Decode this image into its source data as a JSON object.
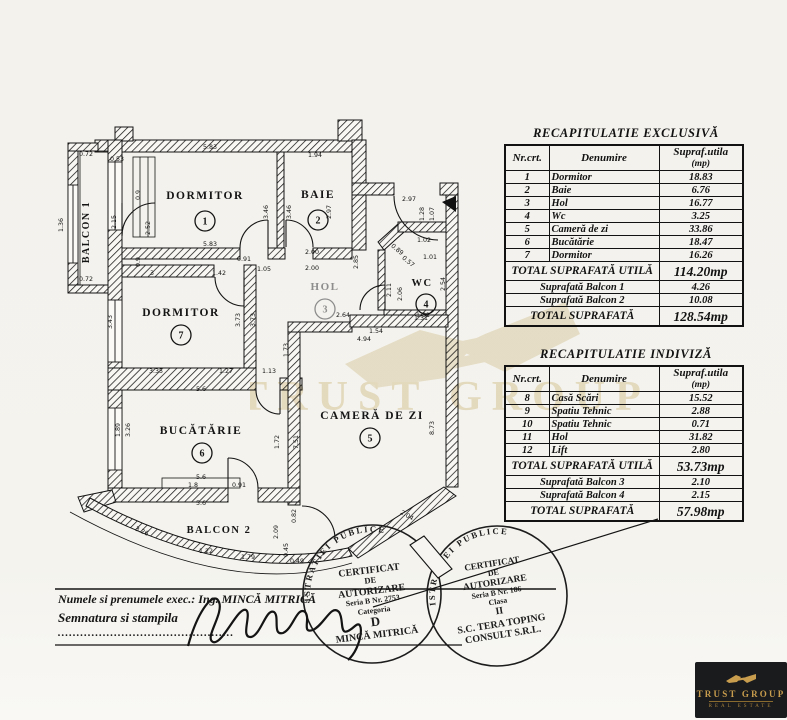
{
  "tables": [
    {
      "title": "RECAPITULATIE  EXCLUSIVĂ",
      "headers": [
        "Nr.crt.",
        "Denumire"
      ],
      "unit_header_line1": "Supraf.utila",
      "unit_header_line2": "(mp)",
      "rows": [
        [
          "1",
          "Dormitor",
          "18.83"
        ],
        [
          "2",
          "Baie",
          "6.76"
        ],
        [
          "3",
          "Hol",
          "16.77"
        ],
        [
          "4",
          "Wc",
          "3.25"
        ],
        [
          "5",
          "Cameră de zi",
          "33.86"
        ],
        [
          "6",
          "Bucătărie",
          "18.47"
        ],
        [
          "7",
          "Dormitor",
          "16.26"
        ]
      ],
      "total_utila_label": "TOTAL SUPRAFATĂ UTILĂ",
      "total_utila_value": "114.20mp",
      "balcon_rows": [
        [
          "Suprafată Balcon 1",
          "4.26"
        ],
        [
          "Suprafată Balcon 2",
          "10.08"
        ]
      ],
      "total_label": "TOTAL SUPRAFATĂ",
      "total_value": "128.54mp"
    },
    {
      "title": "RECAPITULATIE  INDIVIZĂ",
      "headers": [
        "Nr.crt.",
        "Denumire"
      ],
      "unit_header_line1": "Supraf.utila",
      "unit_header_line2": "(mp)",
      "rows": [
        [
          "8",
          "Casă Scări",
          "15.52"
        ],
        [
          "9",
          "Spatiu Tehnic",
          "2.88"
        ],
        [
          "10",
          "Spatiu Tehnic",
          "0.71"
        ],
        [
          "11",
          "Hol",
          "31.82"
        ],
        [
          "12",
          "Lift",
          "2.80"
        ]
      ],
      "total_utila_label": "TOTAL SUPRAFATĂ UTILĂ",
      "total_utila_value": "53.73mp",
      "balcon_rows": [
        [
          "Suprafată Balcon 3",
          "2.10"
        ],
        [
          "Suprafată Balcon 4",
          "2.15"
        ]
      ],
      "total_label": "TOTAL SUPRAFATĂ",
      "total_value": "57.98mp"
    }
  ],
  "floor_plan": {
    "rooms": [
      {
        "name": "balcon-1",
        "label": "BALCON 1",
        "x": 89,
        "y": 232,
        "rot": -90,
        "size": 10
      },
      {
        "name": "dormitor-1",
        "label": "DORMITOR",
        "num": "1",
        "x": 205,
        "y": 199,
        "nx": 205,
        "ny": 221,
        "size": 11.5
      },
      {
        "name": "baie",
        "label": "BAIE",
        "num": "2",
        "x": 318,
        "y": 198,
        "nx": 318,
        "ny": 220,
        "size": 11.5
      },
      {
        "name": "hol",
        "label": "HOL",
        "num": "3",
        "x": 325,
        "y": 290,
        "nx": 325,
        "ny": 309,
        "size": 11,
        "light": true
      },
      {
        "name": "wc",
        "label": "WC",
        "num": "4",
        "x": 422,
        "y": 286,
        "nx": 426,
        "ny": 304,
        "size": 10.5
      },
      {
        "name": "camera-de-zi",
        "label": "CAMERĂ DE ZI",
        "num": "5",
        "x": 372,
        "y": 419,
        "nx": 370,
        "ny": 438,
        "size": 11.5
      },
      {
        "name": "bucatarie",
        "label": "BUCĂTĂRIE",
        "num": "6",
        "x": 201,
        "y": 434,
        "nx": 202,
        "ny": 453,
        "size": 11.5
      },
      {
        "name": "dormitor-7",
        "label": "DORMITOR",
        "num": "7",
        "x": 181,
        "y": 316,
        "nx": 181,
        "ny": 335,
        "size": 11.5
      },
      {
        "name": "balcon-2",
        "label": "BALCON 2",
        "x": 219,
        "y": 533,
        "size": 10.5
      }
    ],
    "dimensions": [
      {
        "t": "0.72",
        "x": 86,
        "y": 156
      },
      {
        "t": "0.53",
        "x": 117,
        "y": 161
      },
      {
        "t": "5.83",
        "x": 210,
        "y": 149
      },
      {
        "t": "1.94",
        "x": 315,
        "y": 157
      },
      {
        "t": "1.36",
        "x": 63,
        "y": 225,
        "r": -90
      },
      {
        "t": "2.15",
        "x": 116,
        "y": 222,
        "r": -90
      },
      {
        "t": "0.9",
        "x": 140,
        "y": 195,
        "r": -90
      },
      {
        "t": "2.52",
        "x": 150,
        "y": 228,
        "r": -90
      },
      {
        "t": "0.9",
        "x": 140,
        "y": 262,
        "r": -90
      },
      {
        "t": "0.72",
        "x": 86,
        "y": 281
      },
      {
        "t": "3.46",
        "x": 268,
        "y": 212,
        "r": -90
      },
      {
        "t": "3.46",
        "x": 291,
        "y": 212,
        "r": -90
      },
      {
        "t": "2.97",
        "x": 331,
        "y": 212,
        "r": -90
      },
      {
        "t": "5.83",
        "x": 210,
        "y": 246
      },
      {
        "t": "2.00",
        "x": 312,
        "y": 254
      },
      {
        "t": "2.00",
        "x": 312,
        "y": 270
      },
      {
        "t": "2.85",
        "x": 358,
        "y": 262,
        "r": -90
      },
      {
        "t": "2.97",
        "x": 409,
        "y": 201
      },
      {
        "t": "1.28",
        "x": 424,
        "y": 214,
        "r": -90
      },
      {
        "t": "1.07",
        "x": 434,
        "y": 214,
        "r": -90
      },
      {
        "t": "1.02",
        "x": 424,
        "y": 242
      },
      {
        "t": "0.89",
        "x": 396,
        "y": 251,
        "r": 40
      },
      {
        "t": "0.57",
        "x": 407,
        "y": 263,
        "r": 40
      },
      {
        "t": "1.01",
        "x": 430,
        "y": 259
      },
      {
        "t": "2.11",
        "x": 391,
        "y": 290,
        "r": -90
      },
      {
        "t": "2.06",
        "x": 402,
        "y": 294,
        "r": -90
      },
      {
        "t": "2.54",
        "x": 445,
        "y": 284,
        "r": -90
      },
      {
        "t": "1.31",
        "x": 421,
        "y": 320
      },
      {
        "t": "0.91",
        "x": 244,
        "y": 261
      },
      {
        "t": "1.05",
        "x": 264,
        "y": 271
      },
      {
        "t": "3",
        "x": 152,
        "y": 275
      },
      {
        "t": "1.42",
        "x": 219,
        "y": 275
      },
      {
        "t": "3.43",
        "x": 112,
        "y": 322,
        "r": -90
      },
      {
        "t": "3.73",
        "x": 240,
        "y": 320,
        "r": -90
      },
      {
        "t": "3.73",
        "x": 255,
        "y": 320,
        "r": -90
      },
      {
        "t": "3.35",
        "x": 156,
        "y": 373
      },
      {
        "t": "1.27",
        "x": 226,
        "y": 373
      },
      {
        "t": "1.13",
        "x": 269,
        "y": 373
      },
      {
        "t": "2.64",
        "x": 343,
        "y": 317
      },
      {
        "t": "1.31",
        "x": 423,
        "y": 317
      },
      {
        "t": "1.54",
        "x": 376,
        "y": 333
      },
      {
        "t": "4.94",
        "x": 364,
        "y": 341
      },
      {
        "t": "1.73",
        "x": 288,
        "y": 350,
        "r": -90
      },
      {
        "t": "7.51",
        "x": 298,
        "y": 442,
        "r": -90
      },
      {
        "t": "8.73",
        "x": 434,
        "y": 428,
        "r": -90
      },
      {
        "t": "5.6",
        "x": 201,
        "y": 391
      },
      {
        "t": "1.89",
        "x": 120,
        "y": 430,
        "r": -90
      },
      {
        "t": "3.26",
        "x": 130,
        "y": 430,
        "r": -90
      },
      {
        "t": "1.72",
        "x": 279,
        "y": 442,
        "r": -90
      },
      {
        "t": "5.6",
        "x": 201,
        "y": 479
      },
      {
        "t": "1.8",
        "x": 193,
        "y": 487
      },
      {
        "t": "0.91",
        "x": 239,
        "y": 487
      },
      {
        "t": "5.6",
        "x": 201,
        "y": 505
      },
      {
        "t": "3.26",
        "x": 141,
        "y": 533,
        "r": 24
      },
      {
        "t": "1.22",
        "x": 206,
        "y": 553
      },
      {
        "t": "1.79",
        "x": 248,
        "y": 559
      },
      {
        "t": "2.09",
        "x": 278,
        "y": 532,
        "r": -90
      },
      {
        "t": "0.82",
        "x": 296,
        "y": 516,
        "r": -90
      },
      {
        "t": "0.45",
        "x": 288,
        "y": 550,
        "r": -90
      },
      {
        "t": "0.49",
        "x": 297,
        "y": 563
      },
      {
        "t": "2.04",
        "x": 406,
        "y": 517,
        "r": 30
      }
    ]
  },
  "stamps": [
    {
      "ring": "MINISTERUL  ADMINISTRATIEI  PUBLICE",
      "lines": [
        "CERTIFICAT",
        "DE",
        "AUTORIZARE",
        "Seria B Nr. 2753",
        "Categoria",
        "D",
        "MINCĂ MITRICĂ"
      ]
    },
    {
      "ring": "MINISTERUL  ADMINISTRATIEI  PUBLICE",
      "lines": [
        "CERTIFICAT",
        "DE",
        "AUTORIZARE",
        "Seria B Nr. 186",
        "Clasa",
        "II",
        "S.C. TERA TOPING",
        "CONSULT S.R.L."
      ]
    }
  ],
  "exec_block": {
    "line1": "Numele si prenumele exec.: Ing.  MINCĂ MITRICĂ",
    "line2": "Semnatura si stampila",
    "dots": "..............................................."
  },
  "watermark": {
    "text": "TRUST GROUP"
  },
  "logo": {
    "title": "TRUST GROUP",
    "subtitle": "REAL ESTATE"
  },
  "colors": {
    "ink": "#121212",
    "watermark": "#ede3c9",
    "gold": "#c89d4d",
    "logo_bg": "#1a1b1d"
  }
}
